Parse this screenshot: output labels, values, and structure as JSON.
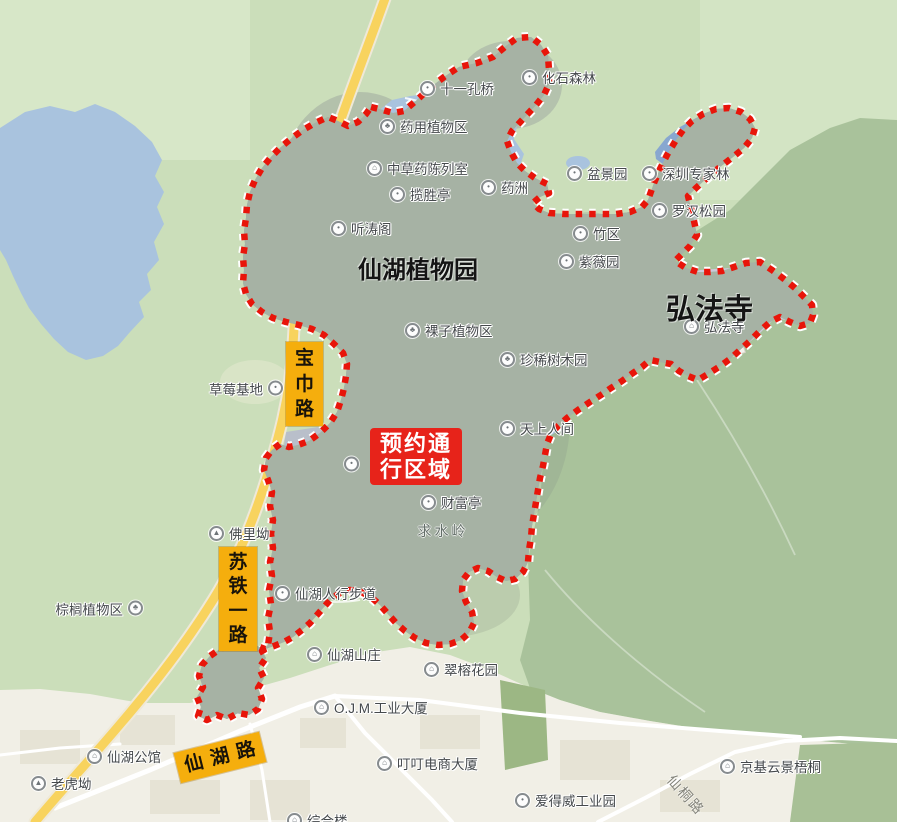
{
  "map": {
    "park_interior_note": "protected scenic area",
    "colors": {
      "boundary_red": "#e8150a",
      "reserve_badge_bg": "#e7231a",
      "road_badge_bg": "#f5ae0d",
      "base_green": "#cbdeba",
      "forest_green": "#a9c29b",
      "park_gray_green": "#a6b2a4",
      "urban_beige": "#f1efe6",
      "water_blue": "#a9c3de",
      "deep_water_blue": "#88a7d0",
      "highway_yellow": "#f8d35e",
      "temple_purple": "#cccadc"
    },
    "area_labels": [
      {
        "text": "仙湖植物园",
        "x": 358,
        "y": 250,
        "size": 24
      },
      {
        "text": "弘法寺",
        "x": 666,
        "y": 286,
        "size": 29
      }
    ],
    "terrain_labels": [
      {
        "text": "求水岭",
        "x": 443,
        "y": 531
      }
    ],
    "pois": [
      {
        "label": "十一孔桥",
        "x": 428,
        "y": 88,
        "icon": "dot-icon"
      },
      {
        "label": "化石森林",
        "x": 530,
        "y": 77,
        "icon": "dot-icon"
      },
      {
        "label": "药用植物区",
        "x": 388,
        "y": 126,
        "icon": "tree-icon"
      },
      {
        "label": "中草药陈列室",
        "x": 375,
        "y": 168,
        "icon": "building-icon"
      },
      {
        "label": "揽胜亭",
        "x": 398,
        "y": 194,
        "icon": "dot-icon"
      },
      {
        "label": "药洲",
        "x": 489,
        "y": 187,
        "icon": "dot-icon"
      },
      {
        "label": "听涛阁",
        "x": 339,
        "y": 228,
        "icon": "dot-icon"
      },
      {
        "label": "盆景园",
        "x": 575,
        "y": 173,
        "icon": "dot-icon"
      },
      {
        "label": "深圳专家林",
        "x": 650,
        "y": 173,
        "icon": "dot-icon"
      },
      {
        "label": "罗汉松园",
        "x": 660,
        "y": 210,
        "icon": "dot-icon"
      },
      {
        "label": "竹区",
        "x": 581,
        "y": 233,
        "icon": "dot-icon"
      },
      {
        "label": "紫薇园",
        "x": 567,
        "y": 261,
        "icon": "dot-icon"
      },
      {
        "label": "弘法寺",
        "x": 692,
        "y": 326,
        "icon": "building-icon"
      },
      {
        "label": "裸子植物区",
        "x": 413,
        "y": 330,
        "icon": "tree-icon"
      },
      {
        "label": "珍稀树木园",
        "x": 508,
        "y": 359,
        "icon": "tree-icon"
      },
      {
        "label": "天上人间",
        "x": 508,
        "y": 428,
        "icon": "dot-icon"
      },
      {
        "label": "",
        "x": 352,
        "y": 464,
        "icon": "dot-icon"
      },
      {
        "label": "财富亭",
        "x": 429,
        "y": 502,
        "icon": "dot-icon"
      },
      {
        "label": "草莓基地",
        "x": 276,
        "y": 388,
        "icon": "dot-icon",
        "side": "left"
      },
      {
        "label": "佛里坳",
        "x": 217,
        "y": 533,
        "icon": "mountain-icon"
      },
      {
        "label": "仙湖人行步道",
        "x": 283,
        "y": 593,
        "icon": "dot-icon"
      },
      {
        "label": "棕榈植物区",
        "x": 136,
        "y": 608,
        "icon": "tree-icon",
        "side": "left"
      },
      {
        "label": "仙湖山庄",
        "x": 315,
        "y": 654,
        "icon": "building-icon"
      },
      {
        "label": "翠榕花园",
        "x": 432,
        "y": 669,
        "icon": "building-icon"
      },
      {
        "label": "O.J.M.工业大厦",
        "x": 322,
        "y": 707,
        "icon": "building-icon"
      },
      {
        "label": "叮叮电商大厦",
        "x": 385,
        "y": 763,
        "icon": "building-icon"
      },
      {
        "label": "仙湖公馆",
        "x": 95,
        "y": 756,
        "icon": "building-icon"
      },
      {
        "label": "老虎坳",
        "x": 39,
        "y": 783,
        "icon": "mountain-icon"
      },
      {
        "label": "爱得威工业园",
        "x": 523,
        "y": 800,
        "icon": "dot-icon"
      },
      {
        "label": "京基云景梧桐",
        "x": 728,
        "y": 766,
        "icon": "building-icon"
      },
      {
        "label": "综合楼",
        "x": 295,
        "y": 820,
        "icon": "building-icon"
      }
    ],
    "icon_glyphs": {
      "dot-icon": "•",
      "tree-icon": "♣",
      "building-icon": "⌂",
      "mountain-icon": "▲"
    },
    "reserve_badge": {
      "lines": [
        "预约通",
        "行区域"
      ],
      "x": 370,
      "y": 428,
      "w": 92,
      "h": 57,
      "size": 22
    },
    "road_badges": [
      {
        "text": "宝巾路",
        "x": 286,
        "y": 342,
        "w": 37,
        "h": 84,
        "size": 19,
        "orient": "vertical"
      },
      {
        "text": "苏铁一路",
        "x": 219,
        "y": 547,
        "w": 38,
        "h": 104,
        "size": 19,
        "orient": "vertical"
      },
      {
        "text": "仙湖路",
        "x": 176,
        "y": 742,
        "w": 88,
        "h": 31,
        "size": 19,
        "orient": "horizontal",
        "rotate": -14
      }
    ],
    "road_names": [
      {
        "text": "仙桐路",
        "x": 686,
        "y": 795,
        "rotate": 48
      }
    ]
  }
}
